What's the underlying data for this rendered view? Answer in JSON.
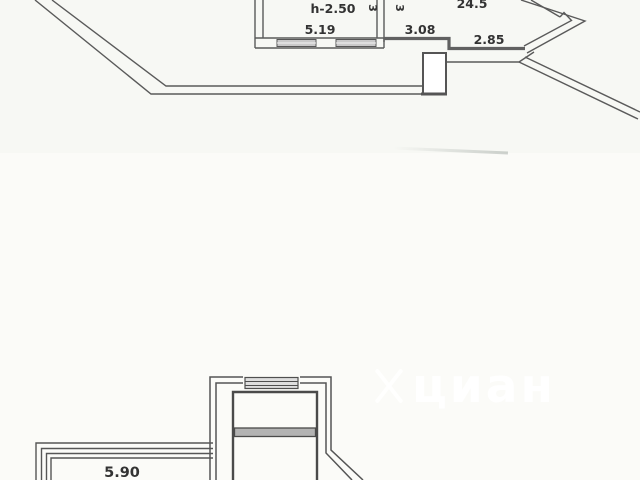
{
  "image_type": "apartment-floor-plan-fragments",
  "colors": {
    "background_upper": "#f7f8f4",
    "background_lower": "#fbfbf8",
    "line": "#5a5a5a",
    "wall": "#4f4f4f",
    "window_fill": "#c9c9c9",
    "divider_fill": "#b3b3b3",
    "label_text": "#333333",
    "watermark": "#ffffff"
  },
  "plan_top": {
    "labels": {
      "ceiling_height": "h-2.50",
      "room_width": "5.19",
      "area": "24.5",
      "hall_width": "3.08",
      "bay_width": "2.85",
      "vertical_left": "3",
      "vertical_right": "3"
    }
  },
  "plan_bottom": {
    "labels": {
      "balcony_width": "5.90"
    }
  },
  "watermark": {
    "text": "циан"
  }
}
